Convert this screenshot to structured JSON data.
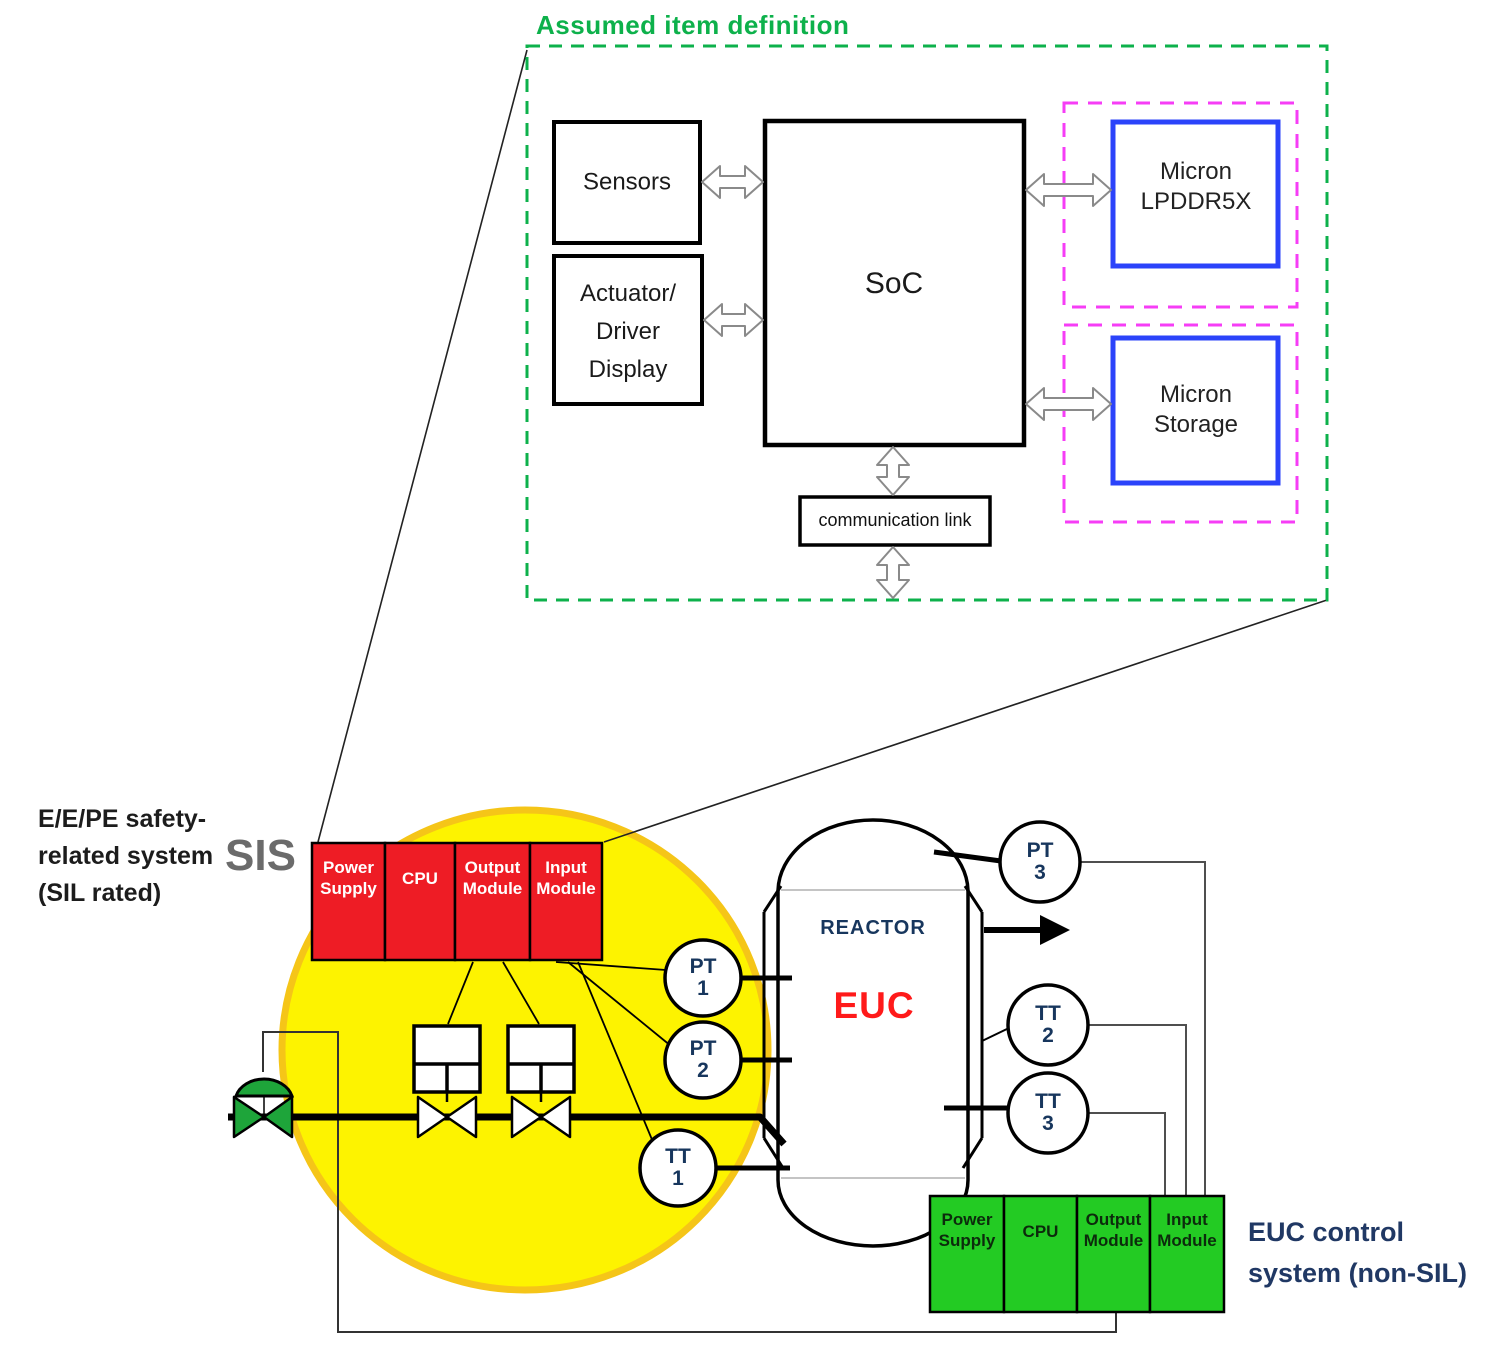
{
  "assumed_item": {
    "title": "Assumed item definition",
    "sensors_label": "Sensors",
    "actuator_lines": [
      "Actuator/",
      "Driver",
      "Display"
    ],
    "soc_label": "SoC",
    "lpddr5x_lines": [
      "Micron",
      "LPDDR5X"
    ],
    "storage_lines": [
      "Micron",
      "Storage"
    ],
    "comm_link_label": "communication link"
  },
  "sis": {
    "system_lines": [
      "E/E/PE safety-",
      "related system",
      "(SIL rated)"
    ],
    "tag": "SIS",
    "modules": [
      "Power Supply",
      "CPU",
      "Output Module",
      "Input Module"
    ]
  },
  "euc_control": {
    "modules": [
      "Power Supply",
      "CPU",
      "Output Module",
      "Input Module"
    ],
    "label_lines": [
      "EUC control",
      "system (non-SIL)"
    ]
  },
  "reactor": {
    "name": "REACTOR",
    "euc": "EUC"
  },
  "instruments": [
    {
      "tag": "PT",
      "num": "1"
    },
    {
      "tag": "PT",
      "num": "2"
    },
    {
      "tag": "TT",
      "num": "1"
    },
    {
      "tag": "PT",
      "num": "3"
    },
    {
      "tag": "TT",
      "num": "2"
    },
    {
      "tag": "TT",
      "num": "3"
    }
  ],
  "colors": {
    "callout_green": "#0db14b",
    "magenta": "#f63df6",
    "memory_blue": "#2b43fa",
    "sis_red": "#ee1c25",
    "euc_green": "#23cb23",
    "zone_yellow": "#fdf300",
    "zone_rim": "#f5c518",
    "valve_green": "#1ea53a",
    "navy": "#17365d",
    "euc_text_red": "#ff1a1a",
    "sis_gray": "#6b6b6b"
  }
}
